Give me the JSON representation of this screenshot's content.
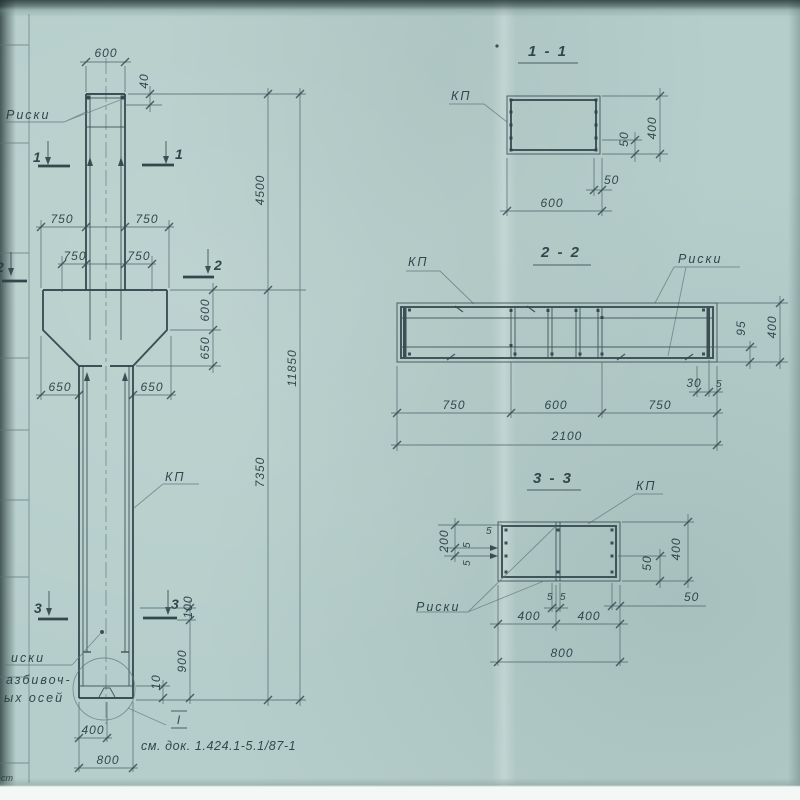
{
  "colors": {
    "paper": "#b6cecb",
    "ink": "#2d4348",
    "ink_light": "#4d666c"
  },
  "main": {
    "riski": "Риски",
    "kp": "КП",
    "cut1": "1",
    "cut2": "2",
    "cut3": "3",
    "d600_top": "600",
    "d40": "40",
    "d750": "750",
    "d4500": "4500",
    "d600_console": "600",
    "d650_v": "650",
    "d650_h": "650",
    "d7350": "7350",
    "d11850": "11850",
    "d100": "100",
    "d900": "900",
    "d10": "10",
    "d400_bottom": "400",
    "d800_bottom": "800",
    "riski_cut": "иски",
    "razbivoch": "азбивоч-",
    "osey": "ых осей",
    "detail_mark": "I",
    "see_doc": "см. док. 1.424.1-5.1/87-1",
    "edge_text": "ст"
  },
  "s11": {
    "title": "1 - 1",
    "kp": "КП",
    "d50_v": "50",
    "d400": "400",
    "d50_h": "50",
    "d600": "600"
  },
  "s22": {
    "title": "2 - 2",
    "kp": "КП",
    "riski": "Риски",
    "d95": "95",
    "d400": "400",
    "d30": "30",
    "d5": "5",
    "d750": "750",
    "d600": "600",
    "d2100": "2100"
  },
  "s33": {
    "title": "3 - 3",
    "kp": "КП",
    "riski": "Риски",
    "d200": "200",
    "d5": "5",
    "d50_r": "50",
    "d400_v": "400",
    "d50_b": "50",
    "d400_a": "400",
    "d400_b": "400",
    "d800": "800"
  }
}
